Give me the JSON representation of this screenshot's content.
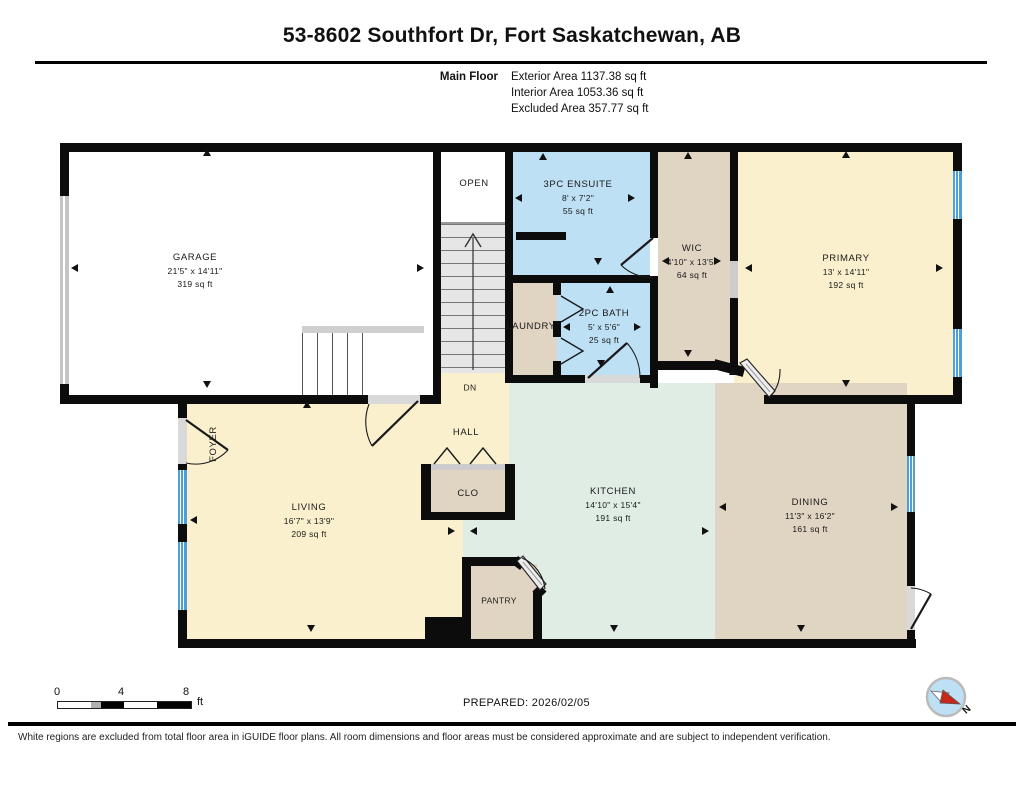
{
  "header": {
    "title": "53-8602 Southfort Dr, Fort Saskatchewan, AB",
    "floor_label": "Main Floor",
    "stats": [
      "Exterior Area 1137.38 sq ft",
      "Interior Area 1053.36 sq ft",
      "Excluded Area 357.77 sq ft"
    ]
  },
  "rooms": [
    {
      "name": "GARAGE",
      "dims": "21'5\" x 14'11\"",
      "area": "319 sq ft"
    },
    {
      "name": "OPEN"
    },
    {
      "name": "3PC ENSUITE",
      "dims": "8' x 7'2\"",
      "area": "55 sq ft"
    },
    {
      "name": "WIC",
      "dims": "4'10\" x 13'5\"",
      "area": "64 sq ft"
    },
    {
      "name": "PRIMARY",
      "dims": "13' x 14'11\"",
      "area": "192 sq ft"
    },
    {
      "name": "LAUNDRY"
    },
    {
      "name": "2PC BATH",
      "dims": "5' x 5'6\"",
      "area": "25 sq ft"
    },
    {
      "name": "DN"
    },
    {
      "name": "HALL"
    },
    {
      "name": "FOYER"
    },
    {
      "name": "LIVING",
      "dims": "16'7\" x 13'9\"",
      "area": "209 sq ft"
    },
    {
      "name": "CLO"
    },
    {
      "name": "KITCHEN",
      "dims": "14'10\" x 15'4\"",
      "area": "191 sq ft"
    },
    {
      "name": "PANTRY"
    },
    {
      "name": "DINING",
      "dims": "11'3\" x 16'2\"",
      "area": "161 sq ft"
    }
  ],
  "scale_bar": {
    "ticks": [
      "0",
      "4",
      "8"
    ],
    "unit": "ft"
  },
  "compass": {
    "label": "N"
  },
  "footer": {
    "prepared": "PREPARED: 2026/02/05",
    "disclaimer": "White regions are excluded from total floor area in iGUIDE floor plans. All room dimensions and floor areas must be considered approximate and are subject to independent verification."
  },
  "colors": {
    "room_cream": "#FAF0CE",
    "room_tan": "#E0D4C3",
    "room_blue": "#BEE0F4",
    "room_mint": "#DFEDE4",
    "window_blue": "#4D9FD6",
    "wall_black": "#0C0C0C"
  }
}
